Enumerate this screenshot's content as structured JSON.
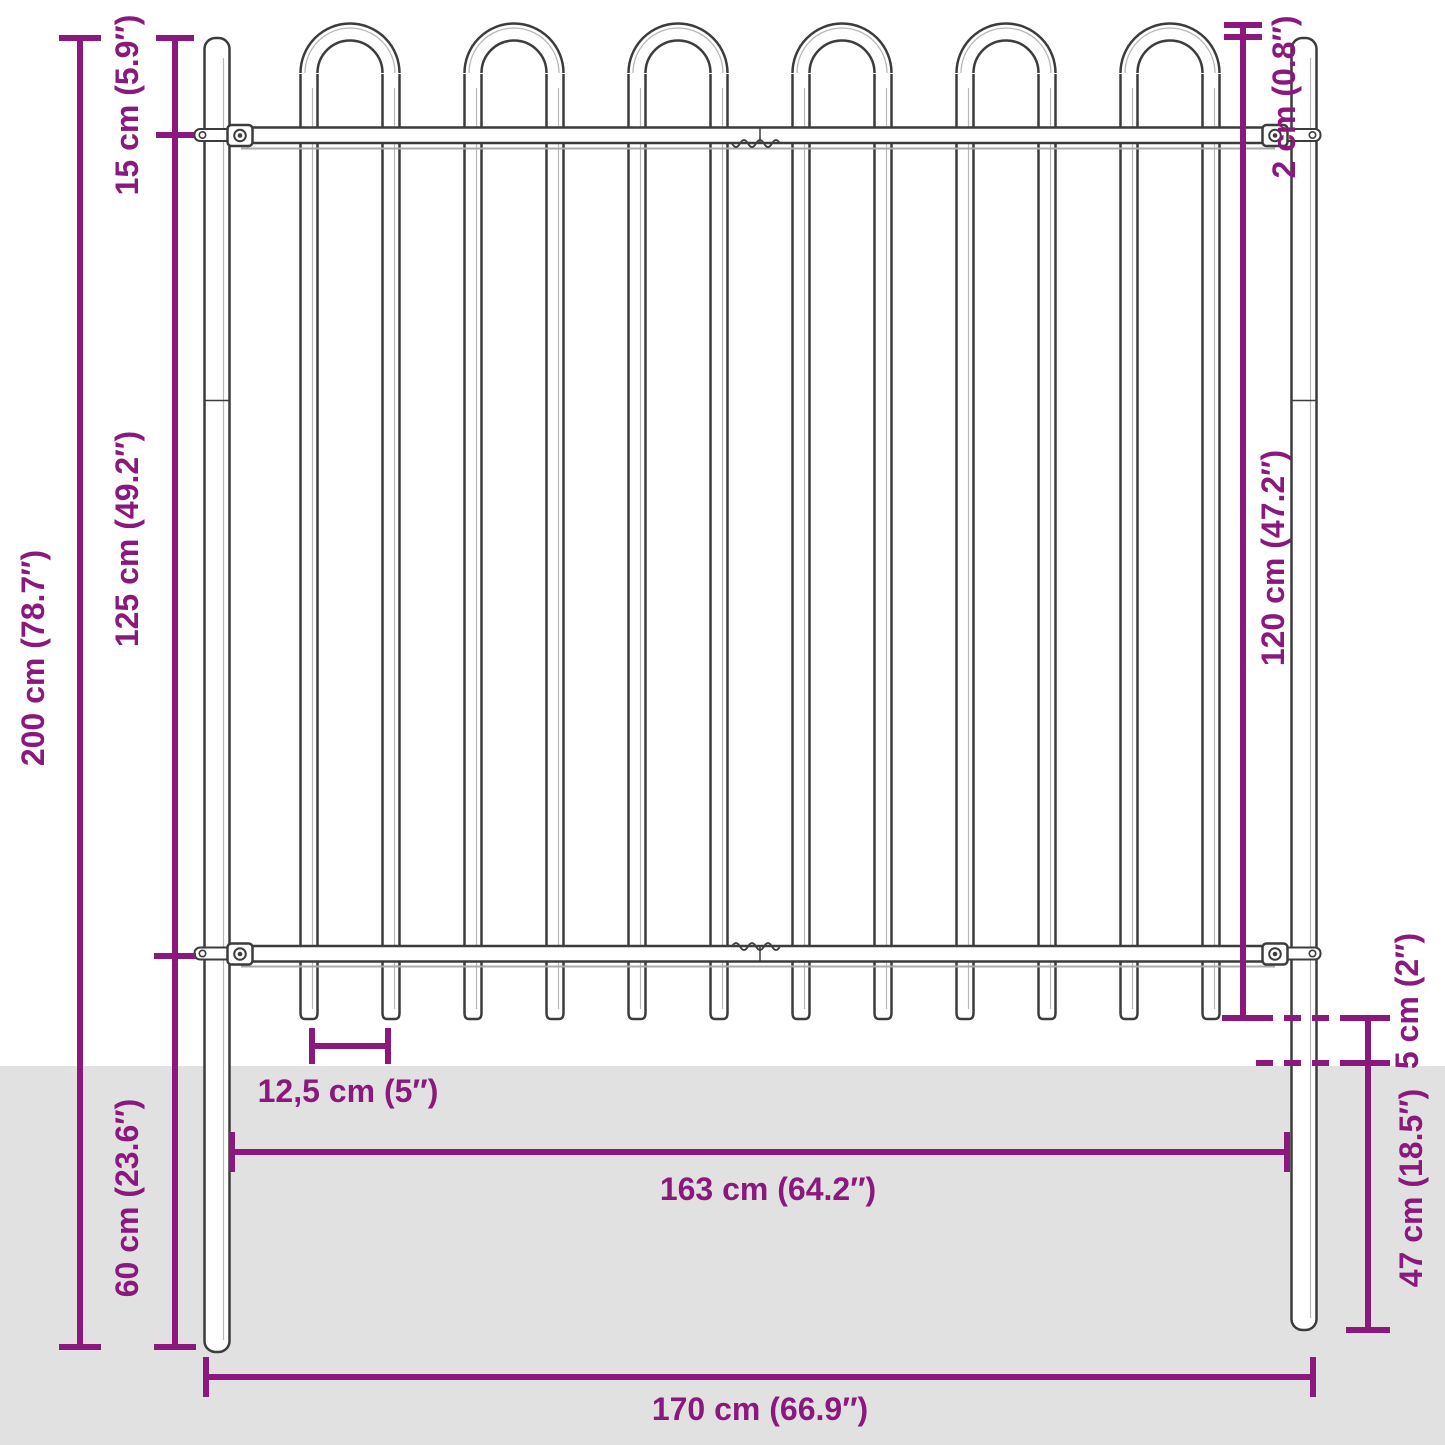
{
  "colors": {
    "dimension_accent": "#8b187d",
    "line_ink": "#3c3c3c",
    "ground_fill": "#e2e1e1",
    "background": "#ffffff"
  },
  "diagram": {
    "fence": {
      "hoop_count": 6,
      "bar_count": 12,
      "rail_count": 2,
      "post_count": 2
    },
    "labels": {
      "total_height": "200 cm (78.7″)",
      "post_top_to_rail": "15 cm (5.9″)",
      "rail_to_rail": "125 cm (49.2″)",
      "ground_depth": "60 cm (23.6″)",
      "hoop_above_post": "2 cm (0.8″)",
      "rail_to_spike": "120 cm (47.2″)",
      "spike_above_ground": "5 cm (2″)",
      "post_below_ground": "47 cm (18.5″)",
      "bar_spacing": "12,5 cm (5″)",
      "inner_width": "163 cm (64.2″)",
      "outer_width": "170 cm (66.9″)"
    }
  }
}
